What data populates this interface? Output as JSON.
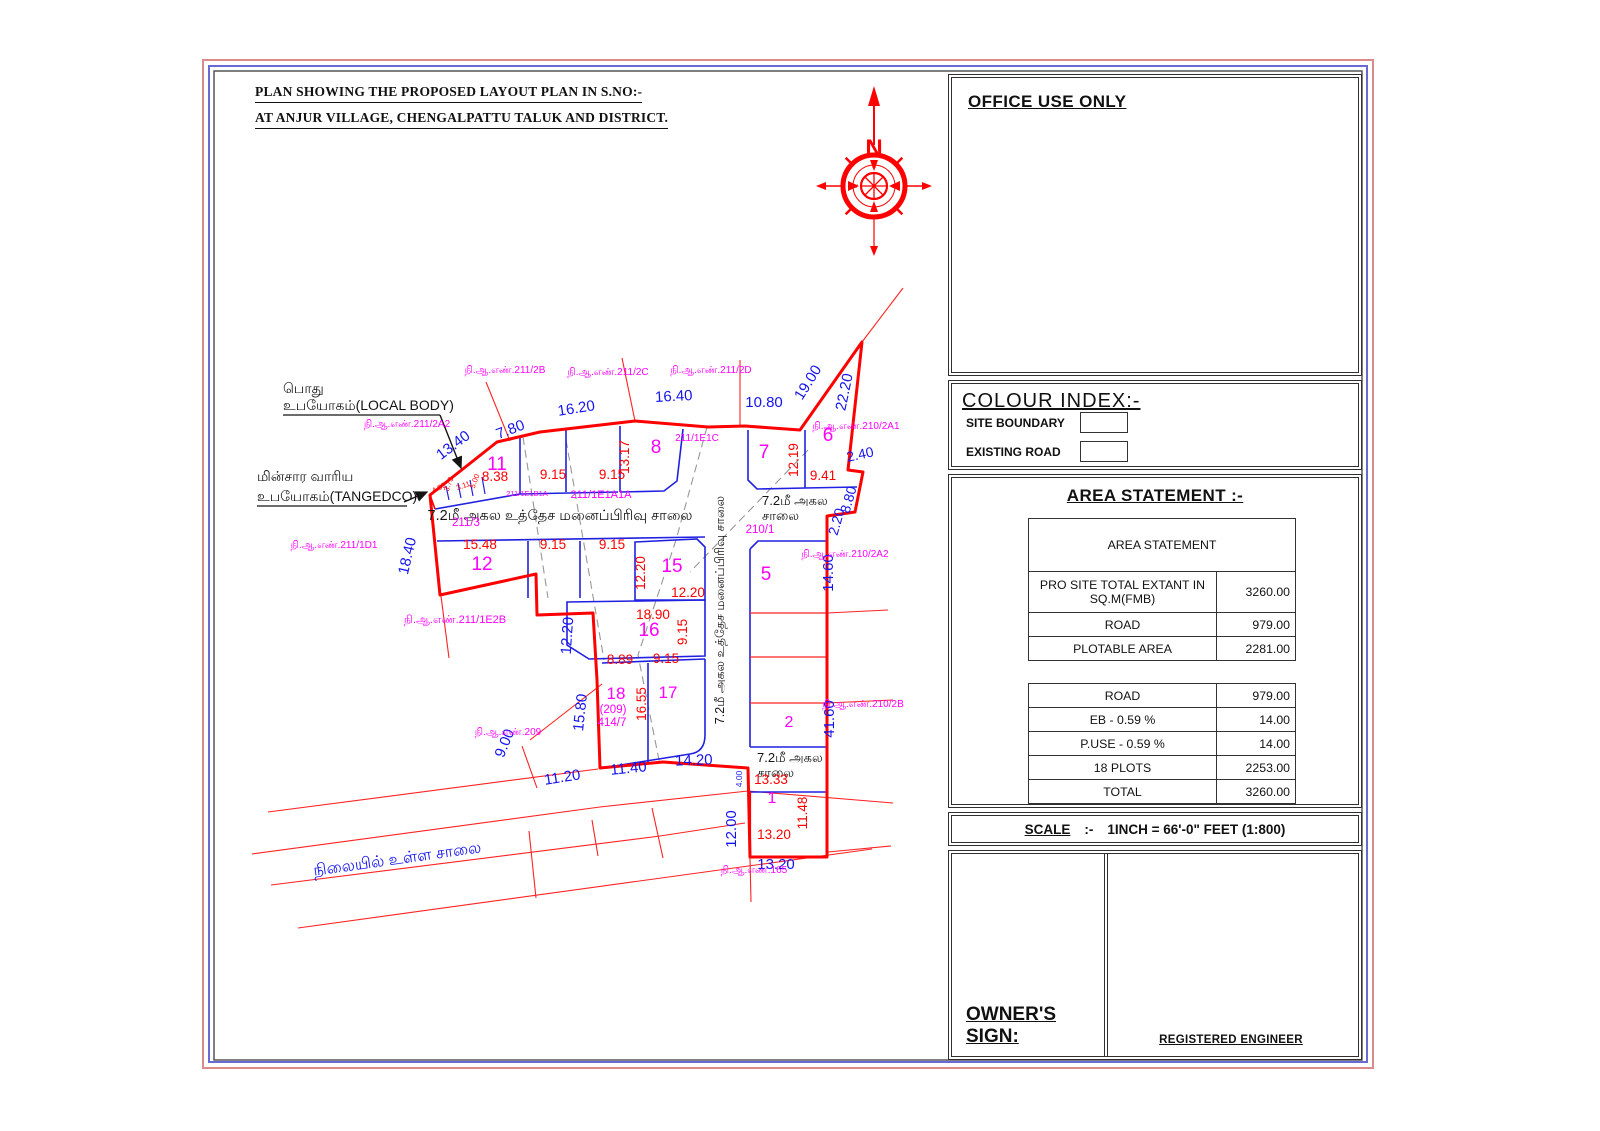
{
  "page": {
    "title_line1": "PLAN SHOWING THE PROPOSED LAYOUT PLAN IN S.NO:-",
    "title_line2": "AT ANJUR VILLAGE,  CHENGALPATTU TALUK AND DISTRICT."
  },
  "colors": {
    "site_boundary": "#ff0000",
    "plot_lines": "#2020e0",
    "dimension_blue": "#1414ee",
    "dimension_red": "#ff0000",
    "survey_magenta": "#ff00ff",
    "compass_red": "#ff0000"
  },
  "compass": {
    "north_label": "N",
    "dirs": [
      "N",
      "E",
      "S",
      "W"
    ]
  },
  "office_panel": {
    "title": "OFFICE USE ONLY"
  },
  "colour_index": {
    "title": "COLOUR INDEX:-",
    "items": [
      {
        "label": "SITE BOUNDARY"
      },
      {
        "label": "EXISTING ROAD"
      }
    ]
  },
  "area_statement": {
    "heading": "AREA STATEMENT :-",
    "table_title": "AREA STATEMENT",
    "rows": [
      {
        "label": "PRO SITE TOTAL EXTANT IN SQ.M(FMB)",
        "value": "3260.00"
      },
      {
        "label": "ROAD",
        "value": "979.00"
      },
      {
        "label": "PLOTABLE AREA",
        "value": "2281.00"
      },
      {
        "label": "ROAD",
        "value": "979.00"
      },
      {
        "label": "EB - 0.59 %",
        "value": "14.00"
      },
      {
        "label": "P.USE - 0.59 %",
        "value": "14.00"
      },
      {
        "label": "18 PLOTS",
        "value": "2253.00"
      },
      {
        "label": "TOTAL",
        "value": "3260.00"
      }
    ]
  },
  "scale": {
    "label": "SCALE",
    "colon": ":-",
    "value": "1INCH  =  66'-0\" FEET (1:800)"
  },
  "signature": {
    "owner": "OWNER'S SIGN:",
    "engineer": "REGISTERED ENGINEER"
  },
  "plan": {
    "labels": [
      {
        "id": "local-body-label-1",
        "t": "பொது",
        "x": 283,
        "y": 393,
        "s": 14,
        "c": "blk",
        "a": "start"
      },
      {
        "id": "local-body-label-2",
        "t": "உபயோகம்(LOCAL BODY)",
        "x": 283,
        "y": 410,
        "s": 14,
        "c": "blk",
        "a": "start"
      },
      {
        "id": "tangedco-label-1",
        "t": "மின்சார வாரிய",
        "x": 257,
        "y": 481,
        "s": 14,
        "c": "blk",
        "a": "start"
      },
      {
        "id": "tangedco-label-2",
        "t": "உபயோகம்(TANGEDCO)",
        "x": 257,
        "y": 501,
        "s": 14,
        "c": "blk",
        "a": "start"
      },
      {
        "id": "road-label-main",
        "t": "7.2மீ அகல உத்தேச மனைப்பிரிவு சாலை",
        "x": 560,
        "y": 520,
        "s": 14.5,
        "c": "blk"
      },
      {
        "id": "road-label-vertical",
        "t": "7.2மீ அகல உத்தேச மனைப்பிரிவு சாலை",
        "x": 724,
        "y": 610,
        "s": 12.5,
        "c": "blk",
        "r": -90
      },
      {
        "id": "road-label-7a",
        "t": "7.2மீ அகல",
        "x": 762,
        "y": 505,
        "s": 13,
        "c": "blk",
        "a": "start"
      },
      {
        "id": "road-label-7b",
        "t": "சாலை",
        "x": 762,
        "y": 520,
        "s": 13,
        "c": "blk",
        "a": "start"
      },
      {
        "id": "road-label-2a",
        "t": "7.2மீ அகல",
        "x": 757,
        "y": 762,
        "s": 13,
        "c": "blk",
        "a": "start"
      },
      {
        "id": "road-label-2b",
        "t": "சாலை",
        "x": 757,
        "y": 777,
        "s": 13,
        "c": "blk",
        "a": "start"
      },
      {
        "id": "existing-road-label",
        "t": "நிலையில் உள்ள சாலை",
        "x": 398,
        "y": 864,
        "s": 16,
        "c": "blu",
        "r": -8
      },
      {
        "id": "dim-13-40",
        "t": "13.40",
        "x": 456,
        "y": 449,
        "s": 15,
        "c": "blu",
        "r": -37
      },
      {
        "id": "dim-7-80",
        "t": "7.80",
        "x": 512,
        "y": 434,
        "s": 15,
        "c": "blu",
        "r": -21
      },
      {
        "id": "dim-16-20",
        "t": "16.20",
        "x": 577,
        "y": 413,
        "s": 15,
        "c": "blu",
        "r": -9
      },
      {
        "id": "dim-16-40",
        "t": "16.40",
        "x": 674,
        "y": 401,
        "s": 15,
        "c": "blu",
        "r": -3
      },
      {
        "id": "dim-10-80",
        "t": "10.80",
        "x": 764,
        "y": 407,
        "s": 15,
        "c": "blu"
      },
      {
        "id": "dim-19-00",
        "t": "19.00",
        "x": 812,
        "y": 385,
        "s": 15,
        "c": "blu",
        "r": -58
      },
      {
        "id": "dim-22-20",
        "t": "22.20",
        "x": 849,
        "y": 393,
        "s": 15,
        "c": "blu",
        "r": -78
      },
      {
        "id": "dim-2-40",
        "t": "2.40",
        "x": 861,
        "y": 459,
        "s": 14,
        "c": "blu",
        "r": -12
      },
      {
        "id": "dim-8-80",
        "t": "8.80",
        "x": 853,
        "y": 501,
        "s": 14,
        "c": "blu",
        "r": -74
      },
      {
        "id": "dim-2-20",
        "t": "2.20",
        "x": 841,
        "y": 523,
        "s": 14,
        "c": "blu",
        "r": -74
      },
      {
        "id": "dim-14-60",
        "t": "14.60",
        "x": 833,
        "y": 573,
        "s": 15,
        "c": "blu",
        "r": -90
      },
      {
        "id": "dim-18-40",
        "t": "18.40",
        "x": 412,
        "y": 557,
        "s": 15,
        "c": "blu",
        "r": -77
      },
      {
        "id": "dim-12-20-blue",
        "t": "12.20",
        "x": 572,
        "y": 636,
        "s": 15,
        "c": "blu",
        "r": -86
      },
      {
        "id": "dim-15-80",
        "t": "15.80",
        "x": 585,
        "y": 713,
        "s": 15,
        "c": "blu",
        "r": -84
      },
      {
        "id": "dim-9-00",
        "t": "9.00",
        "x": 509,
        "y": 745,
        "s": 15,
        "c": "blu",
        "r": -68
      },
      {
        "id": "dim-11-20",
        "t": "11.20",
        "x": 563,
        "y": 782,
        "s": 15,
        "c": "blu",
        "r": -9
      },
      {
        "id": "dim-11-40",
        "t": "11.40",
        "x": 629,
        "y": 773,
        "s": 15,
        "c": "blu",
        "r": -6
      },
      {
        "id": "dim-14-20",
        "t": "14.20",
        "x": 694,
        "y": 765,
        "s": 15,
        "c": "blu",
        "r": -2
      },
      {
        "id": "dim-4-00",
        "t": "4.00",
        "x": 742,
        "y": 779,
        "s": 8.5,
        "c": "blu",
        "r": -90
      },
      {
        "id": "dim-41-60",
        "t": "41.60",
        "x": 834,
        "y": 719,
        "s": 15,
        "c": "blu",
        "r": -90
      },
      {
        "id": "dim-12-00",
        "t": "12.00",
        "x": 736,
        "y": 829,
        "s": 15,
        "c": "blu",
        "r": -90
      },
      {
        "id": "dim-13-20-blue",
        "t": "13.20",
        "x": 776,
        "y": 869,
        "s": 15,
        "c": "blu"
      },
      {
        "id": "dim-4-89",
        "t": "4.89",
        "x": 440,
        "y": 490,
        "s": 7.5,
        "c": "red",
        "r": -28
      },
      {
        "id": "dim-3-73",
        "t": "3.73",
        "x": 451,
        "y": 485,
        "s": 7.5,
        "c": "red",
        "r": -70
      },
      {
        "id": "dim-3-11",
        "t": "3.11",
        "x": 464,
        "y": 488,
        "s": 7.5,
        "c": "red",
        "r": -20
      },
      {
        "id": "dim-5-00",
        "t": "5.00",
        "x": 477,
        "y": 482,
        "s": 7.5,
        "c": "red",
        "r": -70
      },
      {
        "id": "dim-8-38",
        "t": "8.38",
        "x": 495,
        "y": 481,
        "s": 13.5,
        "c": "red"
      },
      {
        "id": "dim-9-15-a",
        "t": "9.15",
        "x": 553,
        "y": 479,
        "s": 13.5,
        "c": "red"
      },
      {
        "id": "dim-9-15-b",
        "t": "9.15",
        "x": 612,
        "y": 479,
        "s": 13.5,
        "c": "red"
      },
      {
        "id": "dim-13-17",
        "t": "13.17",
        "x": 629,
        "y": 457,
        "s": 13.5,
        "c": "red",
        "r": -90
      },
      {
        "id": "dim-12-19",
        "t": "12.19",
        "x": 798,
        "y": 460,
        "s": 13.5,
        "c": "red",
        "r": -90
      },
      {
        "id": "dim-9-41",
        "t": "9.41",
        "x": 823,
        "y": 480,
        "s": 13.5,
        "c": "red"
      },
      {
        "id": "dim-15-48",
        "t": "15.48",
        "x": 480,
        "y": 549,
        "s": 13.5,
        "c": "red"
      },
      {
        "id": "dim-9-15-c",
        "t": "9.15",
        "x": 553,
        "y": 549,
        "s": 13.5,
        "c": "red"
      },
      {
        "id": "dim-9-15-d",
        "t": "9.15",
        "x": 612,
        "y": 549,
        "s": 13.5,
        "c": "red"
      },
      {
        "id": "dim-12-20-red-v",
        "t": "12.20",
        "x": 645,
        "y": 573,
        "s": 13.5,
        "c": "red",
        "r": -90
      },
      {
        "id": "dim-12-20-red",
        "t": "12.20",
        "x": 688,
        "y": 597,
        "s": 13.5,
        "c": "red"
      },
      {
        "id": "dim-18-90",
        "t": "18.90",
        "x": 653,
        "y": 619,
        "s": 13.5,
        "c": "red"
      },
      {
        "id": "dim-9-15-e",
        "t": "9.15",
        "x": 687,
        "y": 632,
        "s": 13.5,
        "c": "red",
        "r": -90
      },
      {
        "id": "dim-8-89",
        "t": "8.89",
        "x": 620,
        "y": 664,
        "s": 13.5,
        "c": "red"
      },
      {
        "id": "dim-9-15-f",
        "t": "9.15",
        "x": 666,
        "y": 663,
        "s": 13.5,
        "c": "red"
      },
      {
        "id": "dim-16-55",
        "t": "16.55",
        "x": 646,
        "y": 704,
        "s": 13.5,
        "c": "red",
        "r": -90
      },
      {
        "id": "dim-13-33",
        "t": "13.33",
        "x": 771,
        "y": 784,
        "s": 13.5,
        "c": "red"
      },
      {
        "id": "dim-11-48",
        "t": "11.48",
        "x": 807,
        "y": 813,
        "s": 13.5,
        "c": "red",
        "r": -90
      },
      {
        "id": "dim-13-20-red",
        "t": "13.20",
        "x": 774,
        "y": 839,
        "s": 13.5,
        "c": "red"
      },
      {
        "id": "plot-11",
        "t": "11",
        "x": 497,
        "y": 470,
        "s": 19,
        "c": "mag"
      },
      {
        "id": "plot-8",
        "t": "8",
        "x": 656,
        "y": 453,
        "s": 19,
        "c": "mag"
      },
      {
        "id": "plot-7",
        "t": "7",
        "x": 764,
        "y": 458,
        "s": 19,
        "c": "mag"
      },
      {
        "id": "plot-6",
        "t": "6",
        "x": 828,
        "y": 441,
        "s": 19,
        "c": "mag"
      },
      {
        "id": "plot-12",
        "t": "12",
        "x": 482,
        "y": 570,
        "s": 19,
        "c": "mag"
      },
      {
        "id": "plot-15",
        "t": "15",
        "x": 672,
        "y": 572,
        "s": 19,
        "c": "mag"
      },
      {
        "id": "plot-16",
        "t": "16",
        "x": 649,
        "y": 636,
        "s": 19,
        "c": "mag"
      },
      {
        "id": "plot-5",
        "t": "5",
        "x": 766,
        "y": 580,
        "s": 19,
        "c": "mag"
      },
      {
        "id": "plot-18",
        "t": "18",
        "x": 616,
        "y": 699,
        "s": 17,
        "c": "mag"
      },
      {
        "id": "plot-18-209",
        "t": "(209)",
        "x": 613,
        "y": 713,
        "s": 11.5,
        "c": "mag"
      },
      {
        "id": "plot-18-414-7",
        "t": "414/7",
        "x": 612,
        "y": 726,
        "s": 11.5,
        "c": "mag"
      },
      {
        "id": "plot-17",
        "t": "17",
        "x": 668,
        "y": 698,
        "s": 17,
        "c": "mag"
      },
      {
        "id": "plot-2",
        "t": "2",
        "x": 789,
        "y": 727,
        "s": 16,
        "c": "mag"
      },
      {
        "id": "plot-1",
        "t": "1",
        "x": 772,
        "y": 803,
        "s": 16,
        "c": "mag"
      },
      {
        "id": "survey-211-2B",
        "t": "நி.ஆ.எண்.211/2B",
        "x": 505,
        "y": 373,
        "s": 10,
        "c": "mag"
      },
      {
        "id": "survey-211-2C",
        "t": "நி.ஆ.எண்.211/2C",
        "x": 608,
        "y": 375,
        "s": 10,
        "c": "mag"
      },
      {
        "id": "survey-211-2D",
        "t": "நி.ஆ.எண்.211/2D",
        "x": 711,
        "y": 373,
        "s": 10,
        "c": "mag"
      },
      {
        "id": "survey-211-2A2",
        "t": "நி.ஆ.எண்.211/2A2",
        "x": 407,
        "y": 427,
        "s": 10,
        "c": "mag"
      },
      {
        "id": "survey-210-2A1",
        "t": "நி.ஆ.எண்.210/2A1",
        "x": 856,
        "y": 429,
        "s": 10,
        "c": "mag"
      },
      {
        "id": "survey-211-1E1C",
        "t": "211/1E1C",
        "x": 697,
        "y": 441,
        "s": 10,
        "c": "mag"
      },
      {
        "id": "survey-211-1E1B1A",
        "t": "211/1E1B1A",
        "x": 527,
        "y": 496,
        "s": 7.5,
        "c": "mag"
      },
      {
        "id": "survey-211-1E1A1A",
        "t": "211/1E1A1A",
        "x": 601,
        "y": 498,
        "s": 11,
        "c": "mag"
      },
      {
        "id": "survey-211-3",
        "t": "211/3",
        "x": 466,
        "y": 526,
        "s": 11.5,
        "c": "mag"
      },
      {
        "id": "survey-211-1D1",
        "t": "நி.ஆ.எண்.211/1D1",
        "x": 334,
        "y": 548,
        "s": 10,
        "c": "mag"
      },
      {
        "id": "survey-210-2A2",
        "t": "நி.ஆ.எண்.210/2A2",
        "x": 845,
        "y": 557,
        "s": 10,
        "c": "mag"
      },
      {
        "id": "survey-211-1E2B",
        "t": "நி.ஆ.எண்.211/1E2B",
        "x": 455,
        "y": 623,
        "s": 11,
        "c": "mag"
      },
      {
        "id": "survey-210-2B",
        "t": "நி.ஆ.எண்.210/2B",
        "x": 863,
        "y": 707,
        "s": 10,
        "c": "mag"
      },
      {
        "id": "survey-209",
        "t": "நி.ஆ.எண்.209",
        "x": 508,
        "y": 735,
        "s": 10,
        "c": "mag"
      },
      {
        "id": "survey-210-1",
        "t": "210/1",
        "x": 760,
        "y": 533,
        "s": 11.5,
        "c": "mag"
      },
      {
        "id": "survey-165",
        "t": "நி.ஆ.எண்.165",
        "x": 754,
        "y": 873,
        "s": 10,
        "c": "mag"
      }
    ]
  }
}
